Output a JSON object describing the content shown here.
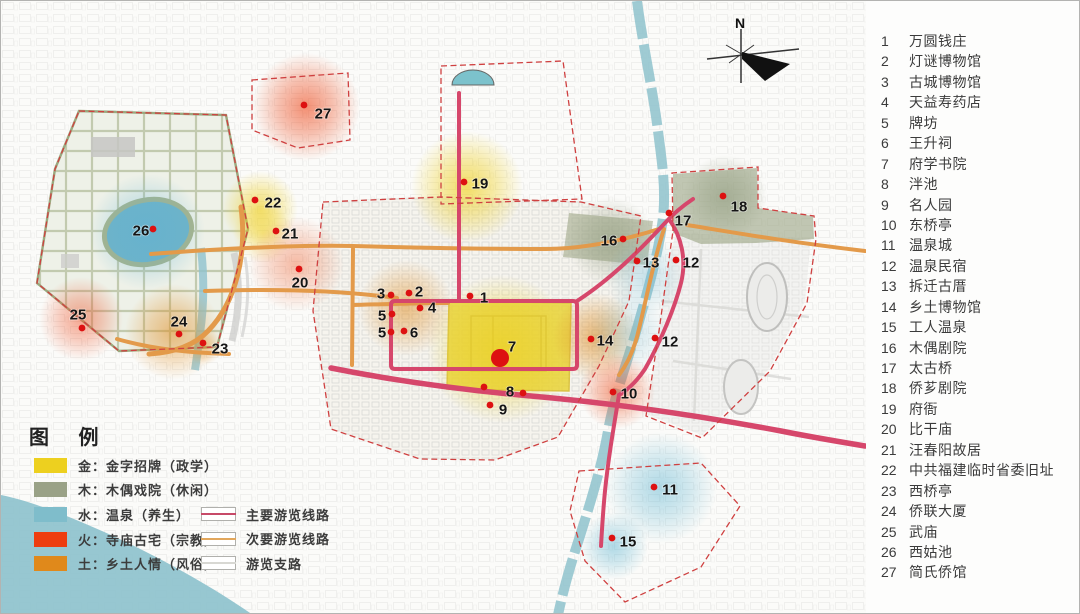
{
  "legend": {
    "title": "图 例",
    "area_items": [
      {
        "label": "金：金字招牌（政学）",
        "color": "#edd01f"
      },
      {
        "label": "木：木偶戏院（休闲）",
        "color": "#9aa287"
      },
      {
        "label": "水：温泉（养生）",
        "color": "#7fbdcb"
      },
      {
        "label": "火：寺庙古宅（宗教）",
        "color": "#ee3d0f"
      },
      {
        "label": "土：乡土人情（风俗）",
        "color": "#e0891b"
      }
    ],
    "route_items": [
      {
        "label": "主要游览线路",
        "color": "#c74a68"
      },
      {
        "label": "次要游览线路",
        "color": "#e2a75c"
      },
      {
        "label": "游览支路",
        "color": "#d8d8d3"
      }
    ]
  },
  "compass": {
    "label": "N"
  },
  "poi_list": [
    {
      "num": "1",
      "name": "万圆钱庄"
    },
    {
      "num": "2",
      "name": "灯谜博物馆"
    },
    {
      "num": "3",
      "name": "古城博物馆"
    },
    {
      "num": "4",
      "name": "天益寿药店"
    },
    {
      "num": "5",
      "name": "牌坊"
    },
    {
      "num": "6",
      "name": "王升祠"
    },
    {
      "num": "7",
      "name": "府学书院"
    },
    {
      "num": "8",
      "name": "泮池"
    },
    {
      "num": "9",
      "name": "名人园"
    },
    {
      "num": "10",
      "name": "东桥亭"
    },
    {
      "num": "11",
      "name": "温泉城"
    },
    {
      "num": "12",
      "name": "温泉民宿"
    },
    {
      "num": "13",
      "name": "拆迁古厝"
    },
    {
      "num": "14",
      "name": "乡土博物馆"
    },
    {
      "num": "15",
      "name": "工人温泉"
    },
    {
      "num": "16",
      "name": "木偶剧院"
    },
    {
      "num": "17",
      "name": "太古桥"
    },
    {
      "num": "18",
      "name": "侨芗剧院"
    },
    {
      "num": "19",
      "name": "府衙"
    },
    {
      "num": "20",
      "name": "比干庙"
    },
    {
      "num": "21",
      "name": "汪春阳故居"
    },
    {
      "num": "22",
      "name": "中共福建临时省委旧址"
    },
    {
      "num": "23",
      "name": "西桥亭"
    },
    {
      "num": "24",
      "name": "侨联大厦"
    },
    {
      "num": "25",
      "name": "武庙"
    },
    {
      "num": "26",
      "name": "西姑池"
    },
    {
      "num": "27",
      "name": "简氏侨馆"
    }
  ],
  "markers": [
    {
      "num": "1",
      "x": 469,
      "y": 295,
      "lx": 483,
      "ly": 296
    },
    {
      "num": "2",
      "x": 408,
      "y": 292,
      "lx": 418,
      "ly": 290
    },
    {
      "num": "3",
      "x": 390,
      "y": 294,
      "lx": 380,
      "ly": 292
    },
    {
      "num": "4",
      "x": 419,
      "y": 307,
      "lx": 431,
      "ly": 306
    },
    {
      "num": "5",
      "x": 391,
      "y": 313,
      "lx": 381,
      "ly": 314
    },
    {
      "num": "5",
      "x": 390,
      "y": 331,
      "lx": 381,
      "ly": 331
    },
    {
      "num": "6",
      "x": 403,
      "y": 330,
      "lx": 413,
      "ly": 331
    },
    {
      "num": "7",
      "x": 499,
      "y": 357,
      "lx": 511,
      "ly": 345,
      "big": true
    },
    {
      "num": "8",
      "x": 522,
      "y": 392,
      "lx": 509,
      "ly": 390
    },
    {
      "num": "9",
      "x": 489,
      "y": 404,
      "lx": 502,
      "ly": 408
    },
    {
      "num": "10",
      "x": 612,
      "y": 391,
      "lx": 628,
      "ly": 392
    },
    {
      "num": "11",
      "x": 653,
      "y": 486,
      "lx": 669,
      "ly": 488
    },
    {
      "num": "12",
      "x": 675,
      "y": 259,
      "lx": 690,
      "ly": 261
    },
    {
      "num": "12",
      "x": 654,
      "y": 337,
      "lx": 669,
      "ly": 340
    },
    {
      "num": "13",
      "x": 636,
      "y": 260,
      "lx": 650,
      "ly": 261
    },
    {
      "num": "14",
      "x": 590,
      "y": 338,
      "lx": 604,
      "ly": 339
    },
    {
      "num": "15",
      "x": 611,
      "y": 537,
      "lx": 627,
      "ly": 540
    },
    {
      "num": "16",
      "x": 622,
      "y": 238,
      "lx": 608,
      "ly": 239
    },
    {
      "num": "17",
      "x": 668,
      "y": 212,
      "lx": 682,
      "ly": 219
    },
    {
      "num": "18",
      "x": 722,
      "y": 195,
      "lx": 738,
      "ly": 205
    },
    {
      "num": "19",
      "x": 463,
      "y": 181,
      "lx": 479,
      "ly": 182
    },
    {
      "num": "20",
      "x": 298,
      "y": 268,
      "lx": 299,
      "ly": 281
    },
    {
      "num": "21",
      "x": 275,
      "y": 230,
      "lx": 289,
      "ly": 232
    },
    {
      "num": "22",
      "x": 254,
      "y": 199,
      "lx": 272,
      "ly": 201
    },
    {
      "num": "23",
      "x": 202,
      "y": 342,
      "lx": 219,
      "ly": 347
    },
    {
      "num": "24",
      "x": 178,
      "y": 333,
      "lx": 178,
      "ly": 320
    },
    {
      "num": "25",
      "x": 81,
      "y": 327,
      "lx": 77,
      "ly": 313
    },
    {
      "num": "26",
      "x": 152,
      "y": 228,
      "lx": 140,
      "ly": 229
    },
    {
      "num": "27",
      "x": 303,
      "y": 104,
      "lx": 322,
      "ly": 112
    },
    {
      "num": "",
      "x": 483,
      "y": 386
    }
  ],
  "glows": [
    {
      "x": 305,
      "y": 106,
      "r": 54,
      "color": "#ee5025",
      "op": 0.7
    },
    {
      "x": 466,
      "y": 186,
      "r": 56,
      "color": "#eecf1e",
      "op": 0.75
    },
    {
      "x": 259,
      "y": 208,
      "r": 38,
      "color": "#eecf1e",
      "op": 0.7
    },
    {
      "x": 262,
      "y": 232,
      "r": 30,
      "color": "#eecf1e",
      "op": 0.5
    },
    {
      "x": 295,
      "y": 263,
      "r": 48,
      "color": "#ee6a3c",
      "op": 0.5
    },
    {
      "x": 146,
      "y": 231,
      "r": 58,
      "color": "#5fb2d4",
      "op": 0.55
    },
    {
      "x": 80,
      "y": 318,
      "r": 42,
      "color": "#ee5025",
      "op": 0.55
    },
    {
      "x": 172,
      "y": 331,
      "r": 48,
      "color": "#df8a1c",
      "op": 0.6
    },
    {
      "x": 405,
      "y": 307,
      "r": 48,
      "color": "#df8a1c",
      "op": 0.55
    },
    {
      "x": 500,
      "y": 348,
      "r": 74,
      "color": "#ecd020",
      "op": 0.75
    },
    {
      "x": 596,
      "y": 336,
      "r": 44,
      "color": "#df8a1c",
      "op": 0.65
    },
    {
      "x": 610,
      "y": 240,
      "r": 44,
      "color": "#8a9678",
      "op": 0.55
    },
    {
      "x": 724,
      "y": 196,
      "r": 42,
      "color": "#8a9678",
      "op": 0.55
    },
    {
      "x": 645,
      "y": 275,
      "r": 40,
      "color": "#6fb6cf",
      "op": 0.4
    },
    {
      "x": 627,
      "y": 332,
      "r": 40,
      "color": "#6fb6cf",
      "op": 0.35
    },
    {
      "x": 616,
      "y": 390,
      "r": 38,
      "color": "#ee5a2d",
      "op": 0.65
    },
    {
      "x": 660,
      "y": 487,
      "r": 56,
      "color": "#62b6d2",
      "op": 0.55
    },
    {
      "x": 613,
      "y": 545,
      "r": 34,
      "color": "#62b6d2",
      "op": 0.55
    },
    {
      "x": 203,
      "y": 346,
      "r": 18,
      "color": "#df8a1c",
      "op": 0.45
    }
  ],
  "map_colors": {
    "marker_dot": "#dd1111",
    "main_route": "#d6476b",
    "secondary_route": "#e39a4a",
    "river": "#8ec2cd",
    "boundary_dashed": "#cf4040",
    "wood_block": "#99a382",
    "gold_block": "#e9d22a"
  }
}
